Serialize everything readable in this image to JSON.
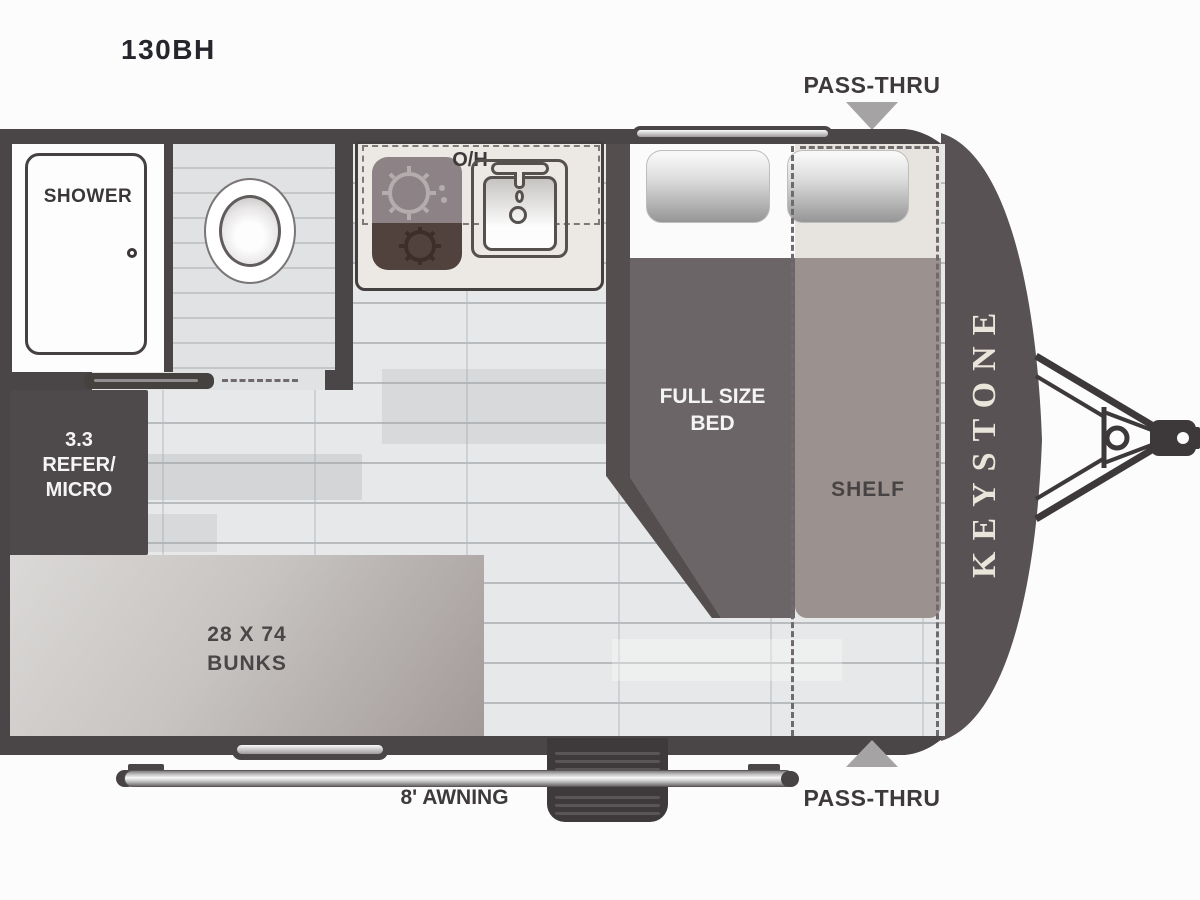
{
  "title": "130BH",
  "brand": "KEYSTONE",
  "labels": {
    "pass_thru_top": "PASS-THRU",
    "pass_thru_bottom": "PASS-THRU",
    "awning": "8' AWNING",
    "overhead": "O/H",
    "shower": "SHOWER",
    "shelf": "SHELF",
    "bed_line1": "FULL SIZE",
    "bed_line2": "BED",
    "refer_line1": "3.3",
    "refer_line2": "REFER/",
    "refer_line3": "MICRO",
    "bunks_line1": "28 X 74",
    "bunks_line2": "BUNKS"
  },
  "colors": {
    "wall": "#4a4546",
    "front_cap": "#585254",
    "floor_base": "#e7e8e9",
    "bathroom_floor": "#e0e2e3",
    "counter": "#ece9e5",
    "bed_blanket": "#6c6567",
    "bed_frame": "#544f4e",
    "shelf": "#9b9290",
    "refer_block": "#4e494a",
    "bunk_dark": "#a29a98",
    "arrow": "#a6a3a4",
    "label_text": "#3e3a3b",
    "brand_text": "#eae5da"
  }
}
